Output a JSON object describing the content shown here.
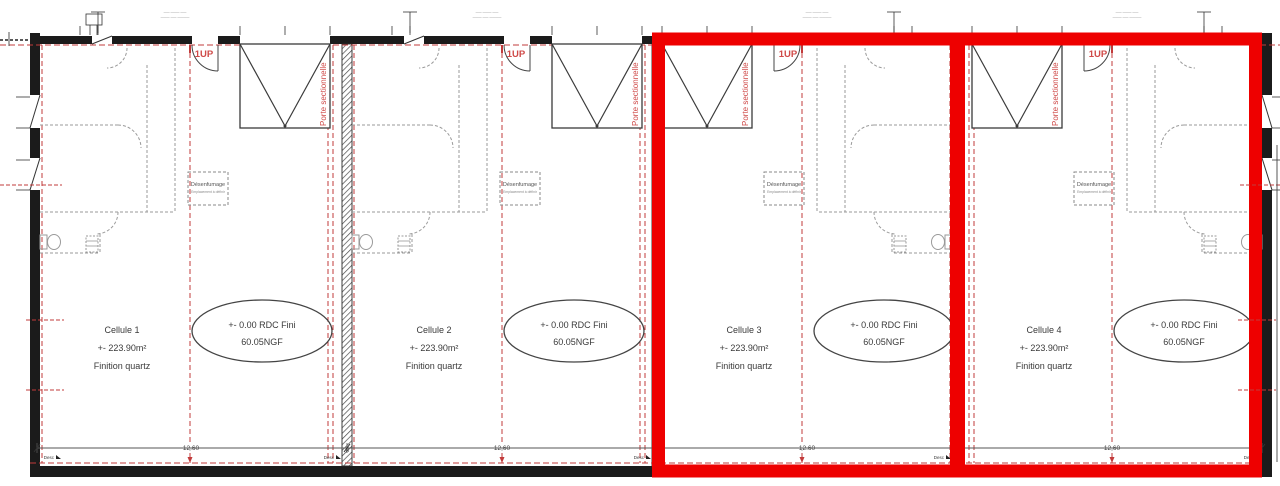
{
  "colors": {
    "highlight_red": "#ee0000",
    "red_line": "#c23b3b",
    "red_text": "#cf4a48",
    "wall_black": "#1b1b1b",
    "interior_gray": "#9a9a9a",
    "text_dark": "#3a3a3a",
    "dim_gray": "#555555"
  },
  "cells": [
    {
      "name": "Cellule 1",
      "highlighted": false
    },
    {
      "name": "Cellule 2",
      "highlighted": false
    },
    {
      "name": "Cellule 3",
      "highlighted": true
    },
    {
      "name": "Cellule 4",
      "highlighted": true
    }
  ],
  "shared": {
    "area": "+- 223.90m²",
    "finish": "Finition quartz",
    "level_line1": "+- 0.00 RDC Fini",
    "level_line2": "60.05NGF",
    "stair_label": "1UP",
    "door_label": "Porte sectionnelle",
    "smoke_line1": "Désenfumage",
    "smoke_line2": "Emplacement à définir",
    "width_dim": "12.60",
    "wall_dim": "20",
    "drain_label": "Desc",
    "note_line1": "—— ——— ——",
    "note_line2": "——— —— ————"
  }
}
